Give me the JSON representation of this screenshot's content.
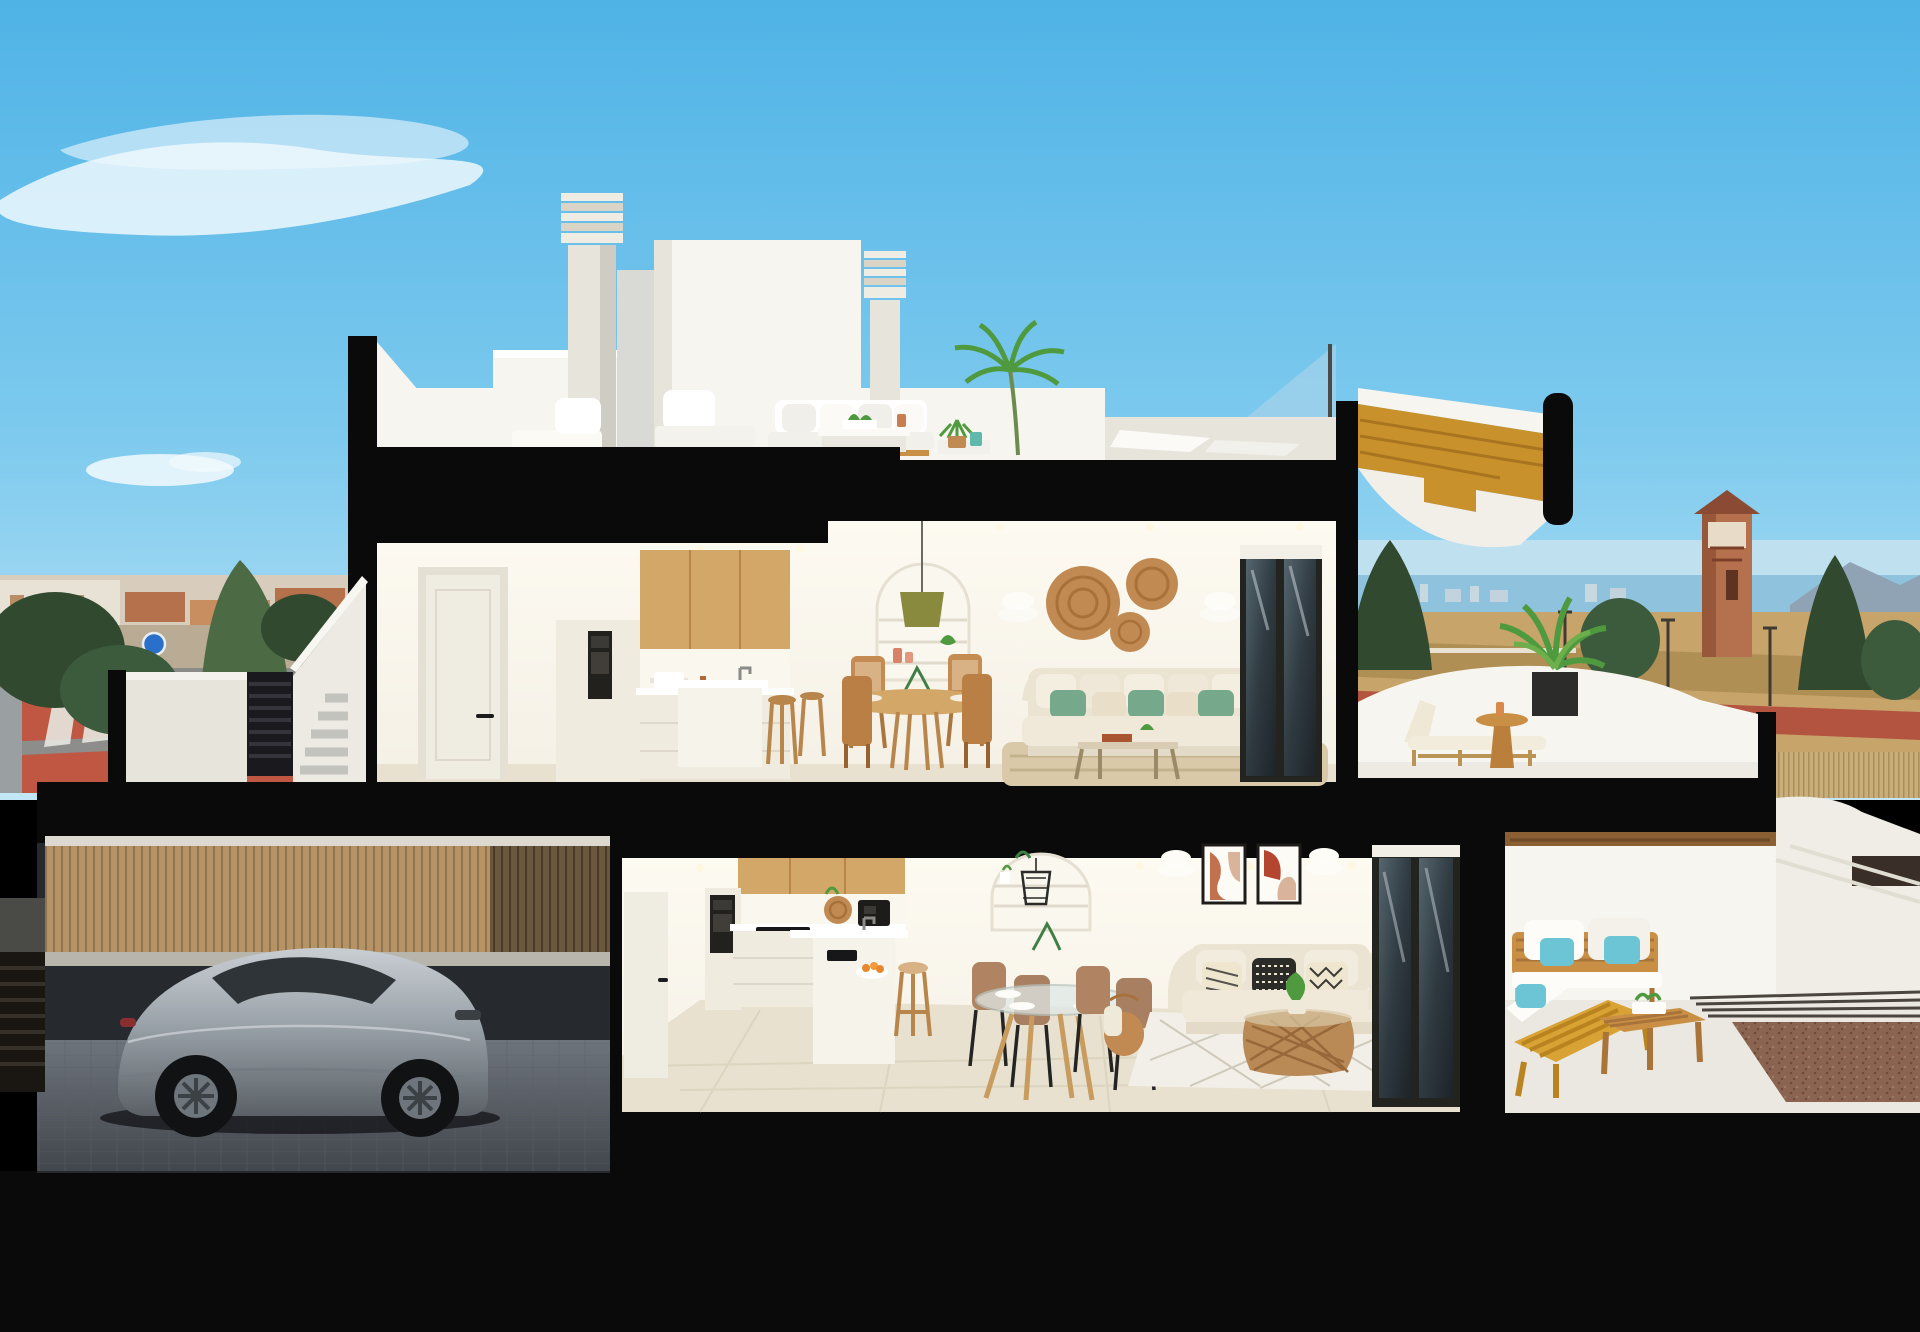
{
  "image": {
    "kind": "architectural-cross-section-render",
    "description_elements": {
      "building": "two-storey duplex cut-away section with black cut edges",
      "roof": "roof terrace with chimneys, stair bulkheads, outdoor lounge set, palm plant, glass balustrade",
      "upper_floor": "kitchen with oak upper cabinets, white island with stools, round wooden dining table, arched shelf niche with pendant, cream sofa with green cushions, rattan wall discs, sliding glass door, private terrace with sun lounger and plant",
      "lower_floor": "kitchen with oak upper cabinets and island, glass dining table with four chairs, arched niche with wire pendant, two abstract art frames, cream sofa with patterned cushions, rattan coffee table, diamond rug, sliding glass doors, covered timber-furniture terrace",
      "garage": "street-level garage with silver sports car behind timber slat fence",
      "surroundings": "left town skyline with street, crosswalk and blue sign; right sea horizon, watch tower, dry field, trees and reed fence"
    }
  },
  "colors": {
    "sky_top": "#4fb3e6",
    "sky_mid": "#7ecaee",
    "sky_low": "#c2e6f6",
    "cloud": "#ffffff",
    "black": "#0a0a0a",
    "white_lit": "#f7f5ef",
    "white_shade": "#e7e4dc",
    "white_cool": "#d9d9d6",
    "interior_wall": "#f4f0e6",
    "interior_glow": "#fdfaf1",
    "floor_tile": "#e8e1cf",
    "floor_dark": "#d9d1bc",
    "wood_cabinet": "#d3a768",
    "wood_dark": "#b8854a",
    "wood_canopy": "#c8912c",
    "wood_outdoor": "#c98f45",
    "slat_fence": "#b59365",
    "slat_line": "#8f7450",
    "slat_dark": "#6b573d",
    "louver_gate": "#1a1a1e",
    "car_body": "#9ba3aa",
    "car_dark": "#5a6066",
    "car_glass": "#2f3438",
    "garage_floor": "#6e747c",
    "garage_wall": "#262a2f",
    "sofa_cream": "#ece4d2",
    "cushion_green": "#76a98b",
    "cushion_teal": "#6cc5d4",
    "cushion_black": "#2b2b28",
    "rattan": "#c08a52",
    "rug_jute": "#d9c9a8",
    "rug_white": "#f2efe8",
    "town_wall": "#d8cdbc",
    "town_roof": "#b4714c",
    "tree_dark": "#31492f",
    "tree_mid": "#4c6b45",
    "plant_green": "#4f9a3f",
    "sea": "#8fc3dd",
    "field": "#c7a469",
    "road_red": "#b35441",
    "road_grey": "#8a8a88",
    "pavement_red": "#bf5743",
    "tower_body": "#b5714e",
    "tower_roof": "#8a4a33",
    "gravel": "#8a6450",
    "glass_pane": "#aed4ea",
    "door_cream": "#efece2",
    "sign_blue": "#2a6fc9",
    "art_terracotta": "#c2714f",
    "art_beige": "#d9b49a",
    "pendant_olive": "#8a8a3f"
  }
}
